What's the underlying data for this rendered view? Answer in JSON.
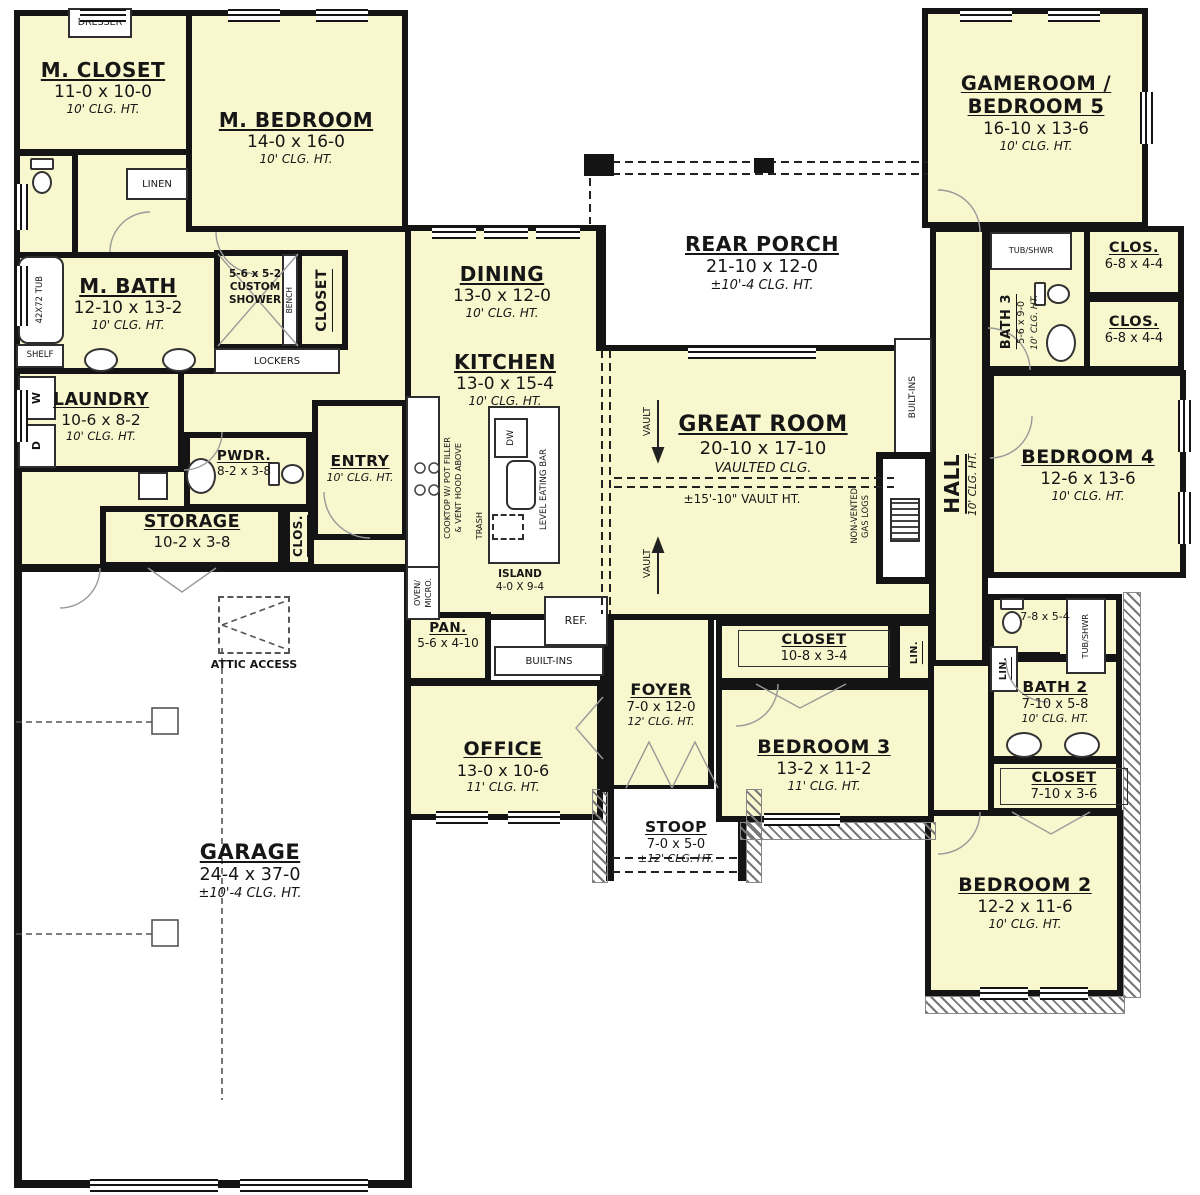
{
  "colors": {
    "room_fill": "#f8f7cd",
    "wall": "#141414",
    "background": "#ffffff"
  },
  "rooms": {
    "m_closet": {
      "name": "M. CLOSET",
      "dims": "11-0 x 10-0",
      "clg": "10' CLG. HT."
    },
    "m_bedroom": {
      "name": "M. BEDROOM",
      "dims": "14-0 x 16-0",
      "clg": "10' CLG. HT."
    },
    "m_bath": {
      "name": "M. BATH",
      "dims": "12-10 x 13-2",
      "clg": "10' CLG. HT."
    },
    "laundry": {
      "name": "LAUNDRY",
      "dims": "10-6 x 8-2",
      "clg": "10' CLG. HT."
    },
    "pwdr": {
      "name": "PWDR.",
      "dims": "8-2 x 3-8"
    },
    "entry": {
      "name": "ENTRY",
      "clg": "10' CLG. HT."
    },
    "storage": {
      "name": "STORAGE",
      "dims": "10-2 x 3-8"
    },
    "clos_entry": {
      "name": "CLOS."
    },
    "garage": {
      "name": "GARAGE",
      "dims": "24-4 x 37-0",
      "clg": "±10'-4 CLG. HT."
    },
    "dining": {
      "name": "DINING",
      "dims": "13-0 x 12-0",
      "clg": "10' CLG. HT."
    },
    "kitchen": {
      "name": "KITCHEN",
      "dims": "13-0 x 15-4",
      "clg": "10' CLG. HT."
    },
    "island": {
      "name": "ISLAND",
      "dims": "4-0 X 9-4"
    },
    "pan": {
      "name": "PAN.",
      "dims": "5-6 x 4-10"
    },
    "office": {
      "name": "OFFICE",
      "dims": "13-0 x 10-6",
      "clg": "11' CLG. HT."
    },
    "foyer": {
      "name": "FOYER",
      "dims": "7-0 x 12-0",
      "clg": "12' CLG. HT."
    },
    "stoop": {
      "name": "STOOP",
      "dims": "7-0 x 5-0",
      "clg": "±12' CLG. HT."
    },
    "rear_porch": {
      "name": "REAR PORCH",
      "dims": "21-10 x 12-0",
      "clg": "±10'-4 CLG. HT."
    },
    "great_room": {
      "name": "GREAT ROOM",
      "dims": "20-10 x 17-10",
      "clg": "VAULTED CLG.",
      "vault": "±15'-10\" VAULT HT."
    },
    "gameroom": {
      "name": "GAMEROOM /",
      "name2": "BEDROOM 5",
      "dims": "16-10 x 13-6",
      "clg": "10' CLG. HT."
    },
    "bath3": {
      "name": "BATH 3",
      "dims": "5-6 x 9-0",
      "clg": "10' CLG. HT."
    },
    "clos3a": {
      "name": "CLOS.",
      "dims": "6-8 x 4-4"
    },
    "clos3b": {
      "name": "CLOS.",
      "dims": "6-8 x 4-4"
    },
    "bedroom4": {
      "name": "BEDROOM 4",
      "dims": "12-6 x 13-6",
      "clg": "10' CLG. HT."
    },
    "hall": {
      "name": "HALL",
      "clg": "10' CLG. HT."
    },
    "bath2_wc": {
      "dims": "7-8 x 5-4"
    },
    "bath2": {
      "name": "BATH 2",
      "dims": "7-10 x 5-8",
      "clg": "10' CLG. HT."
    },
    "closet_b2": {
      "name": "CLOSET",
      "dims": "7-10 x 3-6"
    },
    "bedroom2": {
      "name": "BEDROOM 2",
      "dims": "12-2 x 11-6",
      "clg": "10' CLG. HT."
    },
    "closet_b3": {
      "name": "CLOSET",
      "dims": "10-8 x 3-4"
    },
    "bedroom3": {
      "name": "BEDROOM 3",
      "dims": "13-2 x 11-2",
      "clg": "11' CLG. HT."
    }
  },
  "features": {
    "dresser": "DRESSER",
    "linen": "LINEN",
    "tub": "42X72 TUB",
    "shelf": "SHELF",
    "shower_dims": "5-6 x 5-2",
    "shower_l1": "CUSTOM",
    "shower_l2": "SHOWER",
    "bench": "BENCH",
    "closet2": "CLOSET",
    "lockers": "LOCKERS",
    "washer": "W",
    "dryer": "D",
    "attic": "ATTIC ACCESS",
    "cooktop_l1": "COOKTOP W/ POT FILLER",
    "cooktop_l2": "& VENT HOOD ABOVE",
    "oven_l1": "OVEN/",
    "oven_l2": "MICRO.",
    "trash": "TRASH",
    "dw": "DW",
    "eating_bar": "LEVEL EATING BAR",
    "ref": "REF.",
    "builtins": "BUILT-INS",
    "builtins_gr": "BUILT-INS",
    "gas_l1": "NON-VENTED",
    "gas_l2": "GAS LOGS",
    "vault": "VAULT",
    "tub_shwr": "TUB/SHWR",
    "lin": "LIN."
  }
}
